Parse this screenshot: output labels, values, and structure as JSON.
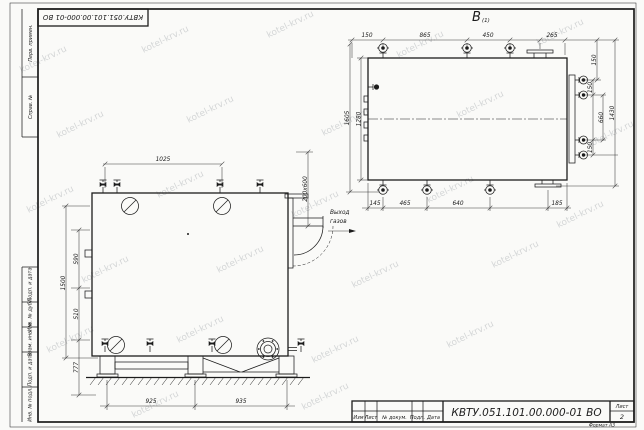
{
  "watermark": "kotel-krv.ru",
  "stamp_top": {
    "doc_number": "КВТУ.051.101.00.000-01  ВО"
  },
  "frame_labels": [
    "Перв. примен.",
    "Справ. №",
    "Подп. и дата",
    "Инв. № дубл.",
    "Взам. инв. №",
    "Подп. и дата",
    "Инв. № подл."
  ],
  "view_b": {
    "label": "В",
    "label_sub": "(1)",
    "dims": {
      "top": [
        "150",
        "865",
        "450",
        "265"
      ],
      "top_right": "150",
      "left": [
        "1605",
        "1280"
      ],
      "right": [
        "150",
        "660",
        "150"
      ],
      "right_overall": "1430",
      "bottom": [
        "145",
        "465",
        "640",
        "185"
      ]
    }
  },
  "front_view": {
    "dims": {
      "top": "1025",
      "left_overall": "1500",
      "left": [
        "590",
        "510",
        "777"
      ],
      "bottom": [
        "925",
        "935"
      ],
      "flue": "200x600"
    },
    "flue_label": {
      "line1": "Выход",
      "line2": "газов"
    }
  },
  "title_block": {
    "doc_number": "КВТУ.051.101.00.000-01  ВО",
    "columns": [
      "Изм",
      "Лист",
      "№ докум.",
      "Подп.",
      "Дата"
    ],
    "sheet_label": "Лист",
    "sheet_number": "2",
    "format": "Формат  А3"
  }
}
